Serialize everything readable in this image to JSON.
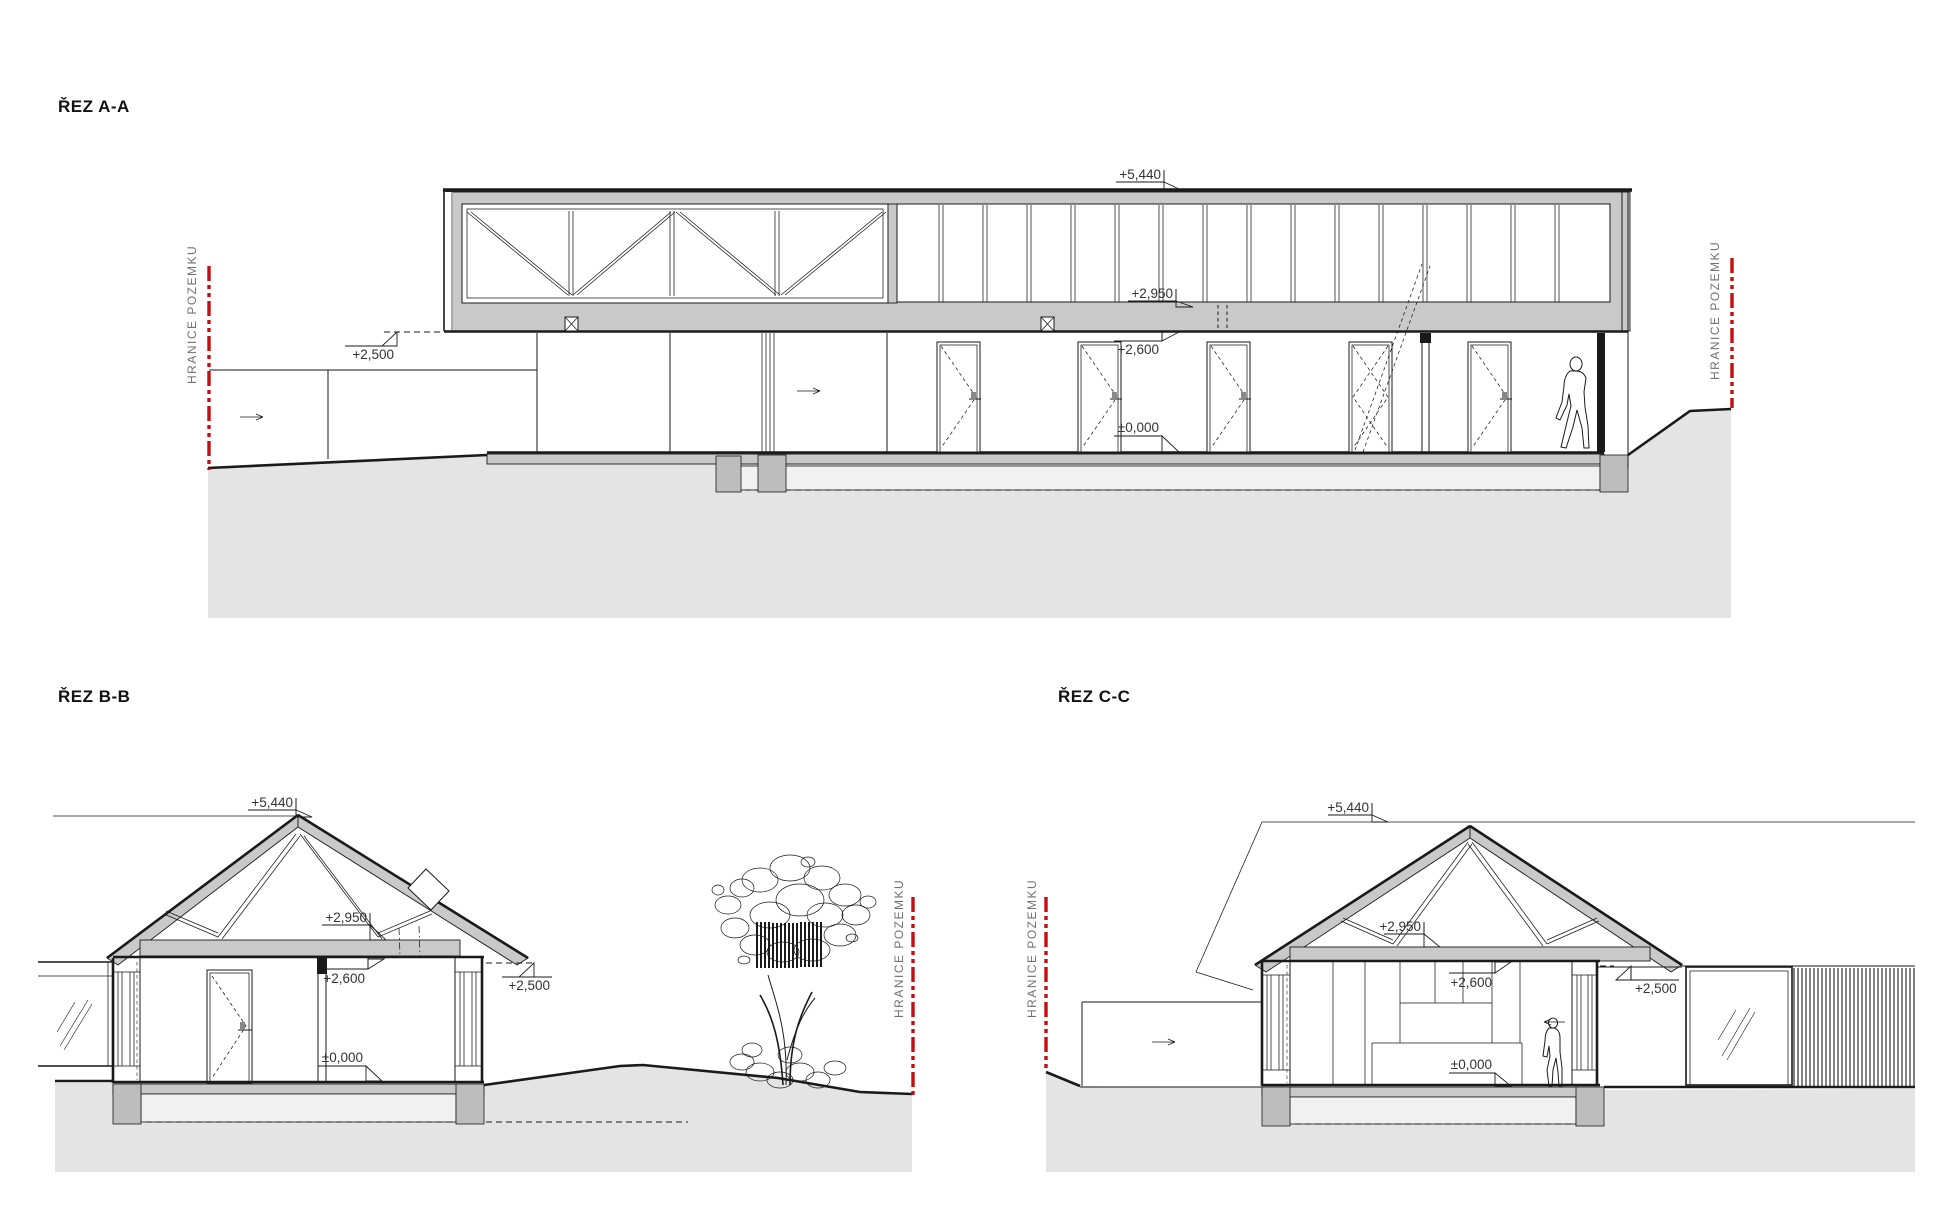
{
  "sections": {
    "a": {
      "title": "ŘEZ A-A"
    },
    "b": {
      "title": "ŘEZ B-B"
    },
    "c": {
      "title": "ŘEZ C-C"
    }
  },
  "labels": {
    "boundary": "HRANICE POZEMKU",
    "level_5440": "+5,440",
    "level_2950": "+2,950",
    "level_2600": "+2,600",
    "level_zero": "±0,000",
    "level_2500": "+2,500"
  },
  "colors": {
    "boundary_red": "#c40f11",
    "cut_gray": "#c9c9c9",
    "ground_gray": "#e4e4e4",
    "pier_gray": "#bdbdbd",
    "line": "#1a1a1a",
    "dim_text": "#333333",
    "boundary_text": "#707070"
  }
}
